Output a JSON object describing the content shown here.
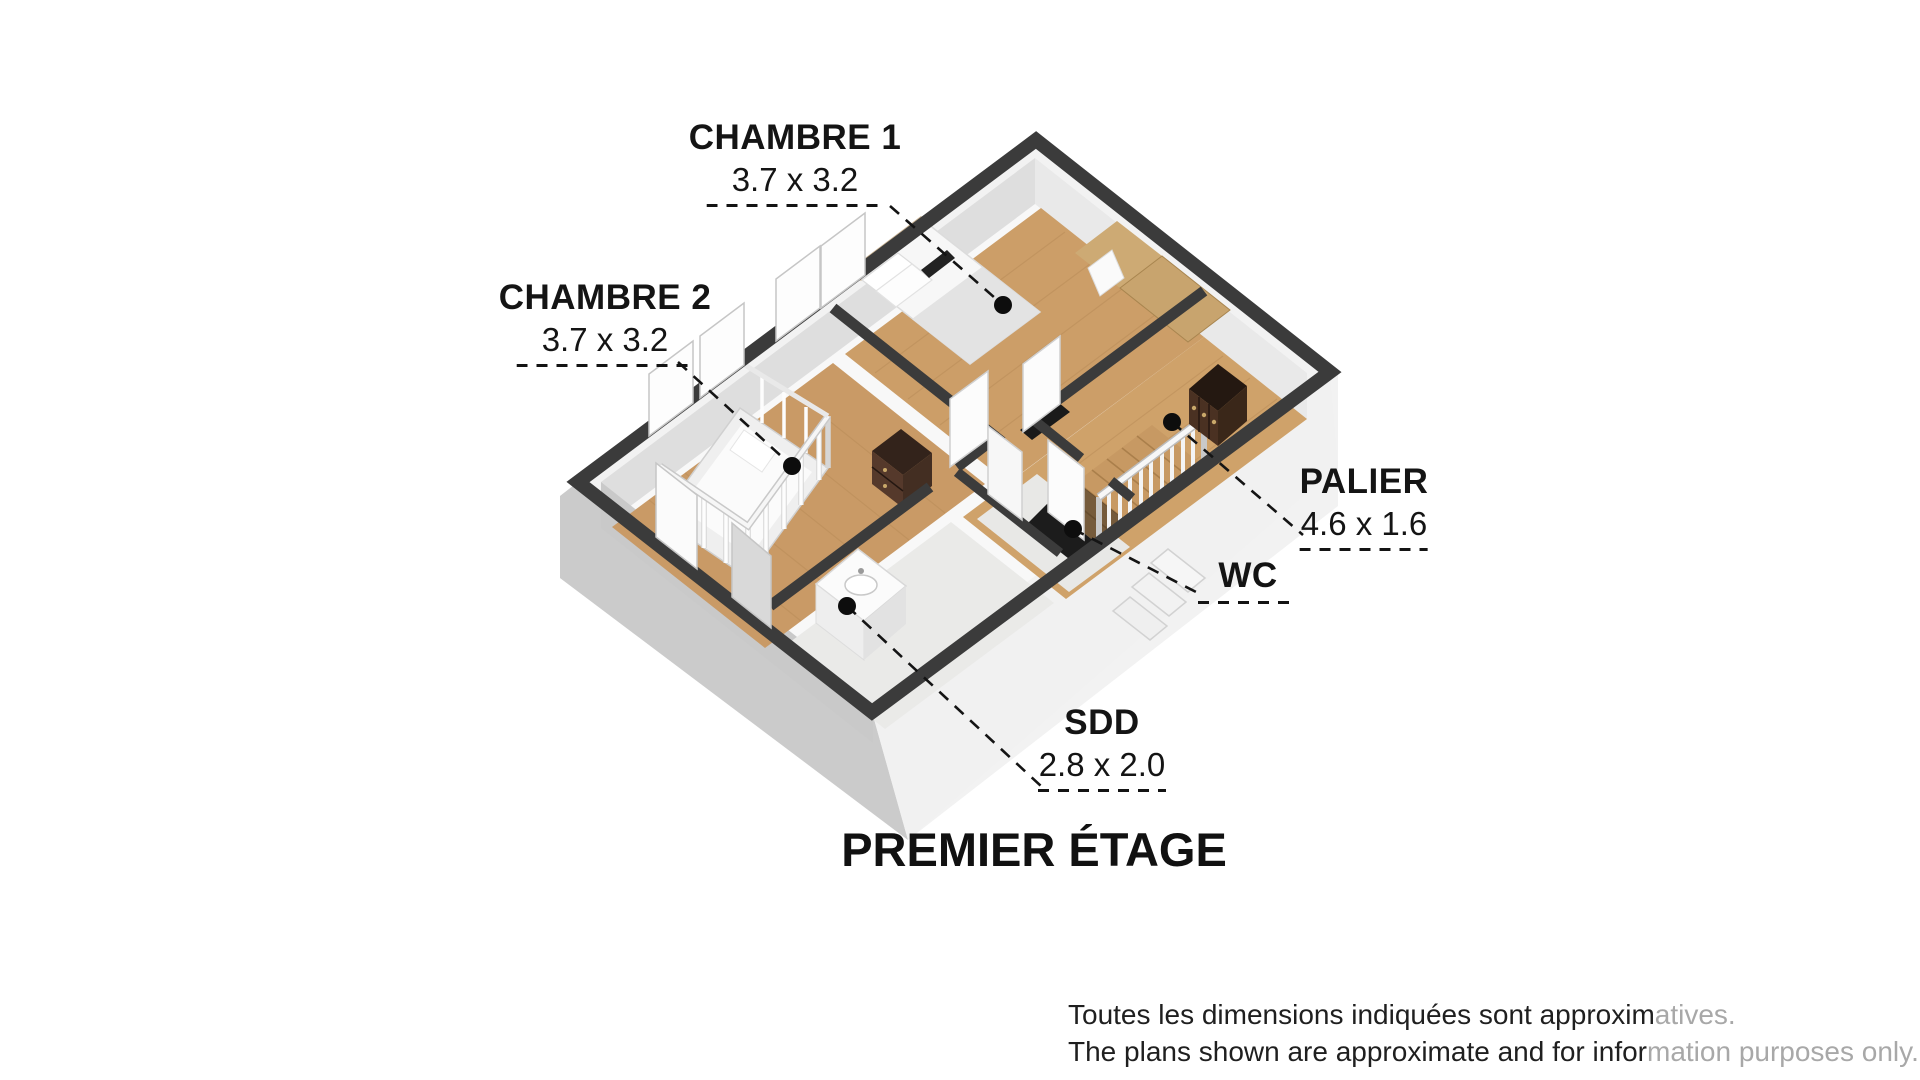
{
  "title": {
    "text": "PREMIER ÉTAGE"
  },
  "callouts": {
    "chambre1": {
      "name": "CHAMBRE 1",
      "dims": "3.7 x 3.2"
    },
    "chambre2": {
      "name": "CHAMBRE 2",
      "dims": "3.7 x 3.2"
    },
    "palier": {
      "name": "PALIER",
      "dims": "4.6 x 1.6"
    },
    "wc": {
      "name": "WC"
    },
    "sdd": {
      "name": "SDD",
      "dims": "2.8 x 2.0"
    }
  },
  "disclaimer": {
    "line1": {
      "dark": "Toutes les dimensions indiquées sont approxim",
      "faded": "atives."
    },
    "line2": {
      "dark": "The plans shown are approximate and for infor",
      "faded": "mation purposes only."
    }
  },
  "floorplan": {
    "view": "isometric-3d",
    "floor": "first floor",
    "rooms": [
      "CHAMBRE 1",
      "CHAMBRE 2",
      "PALIER",
      "WC",
      "SDD"
    ],
    "furniture": [
      "double-bed",
      "headboard",
      "pillows",
      "tv",
      "desk-wardrobe",
      "crib",
      "dresser",
      "chest-of-drawers",
      "vanity-sink",
      "staircase",
      "stair-railing",
      "exterior-steps"
    ],
    "colors": {
      "wall_top": "#3b3b3b",
      "wood_floor": "#cc9e68",
      "tile_floor": "#eaeae8",
      "slab_light": "#f1f1f1",
      "slab_shadow": "#cbcbcb",
      "furniture_brown": "#55392b",
      "tan_accent": "#c9b292",
      "callout_ink": "#141414"
    }
  }
}
